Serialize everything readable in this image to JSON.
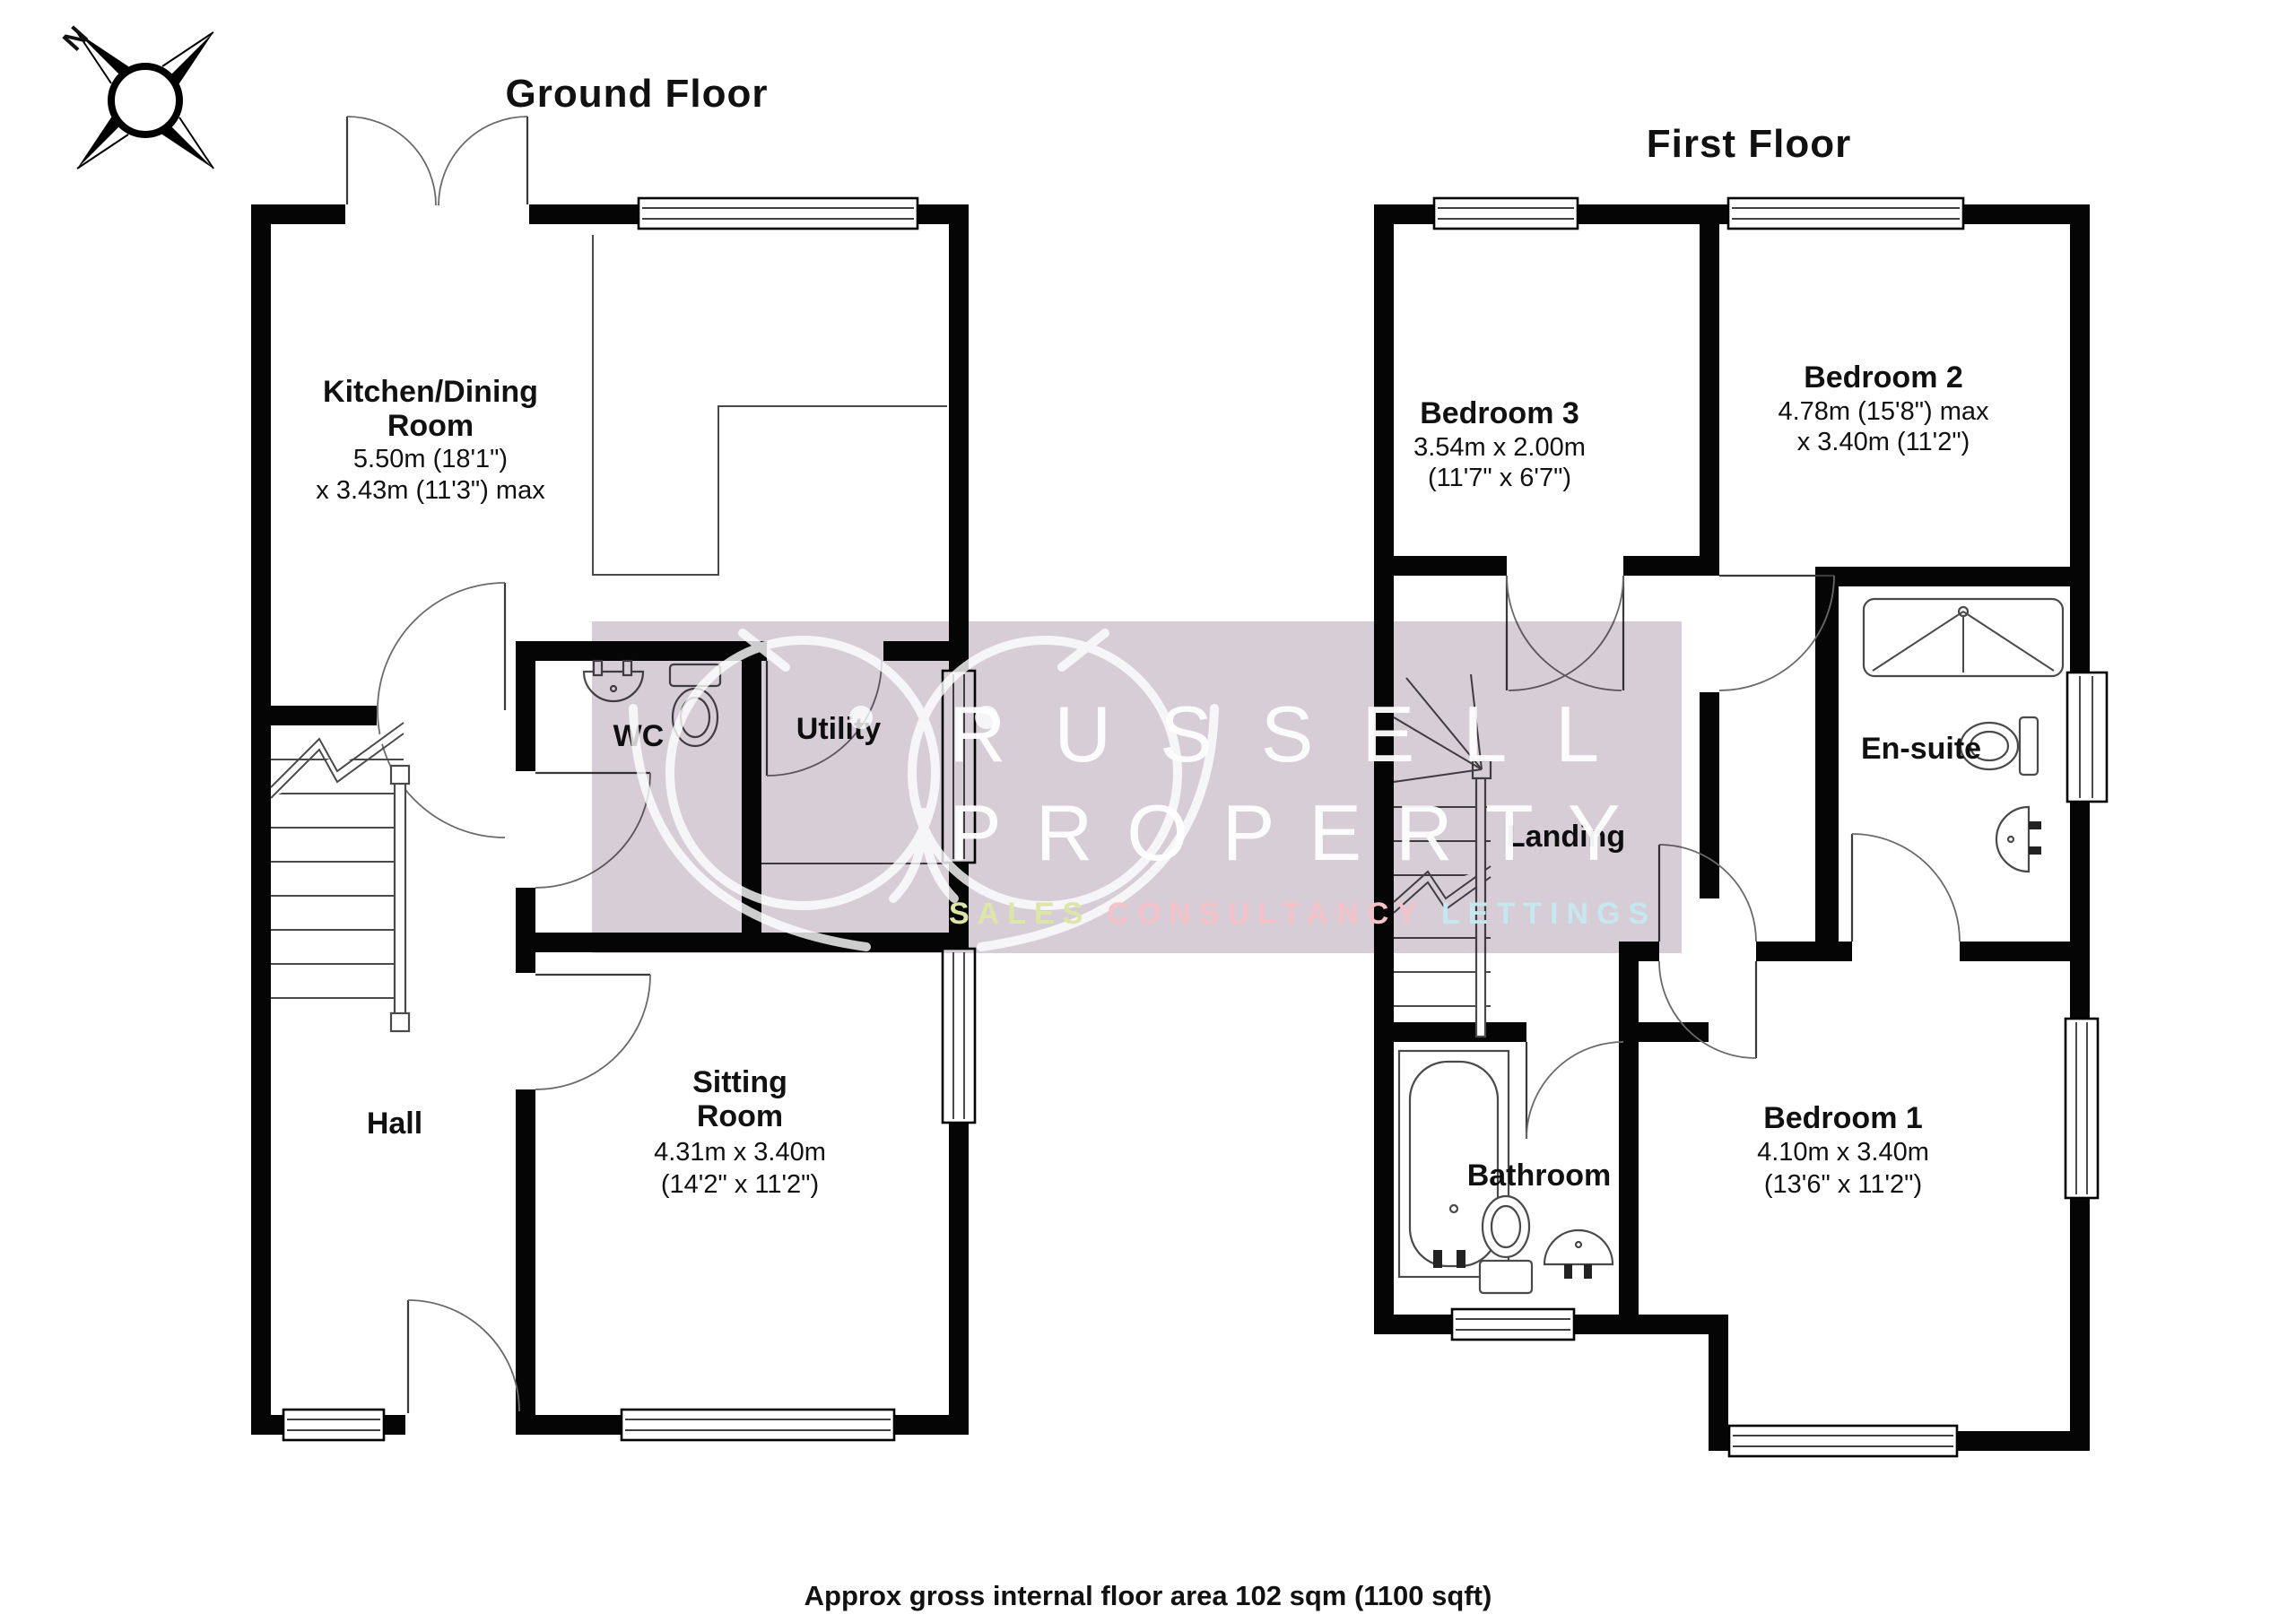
{
  "header": {
    "ground_floor_title": "Ground Floor",
    "first_floor_title": "First Floor",
    "compass_label": "N"
  },
  "footer": {
    "area_note": "Approx gross internal floor area 102 sqm (1100 sqft)"
  },
  "watermark": {
    "line1": "RUSSELL",
    "line2": "PROPERTY",
    "sales_label": "SALES",
    "consultancy_label": "CONSULTANCY",
    "lettings_label": "LETTINGS",
    "band_color": "#d6cdd7",
    "sales_color": "#dde6a6",
    "consultancy_color": "#f6c2c9",
    "lettings_color": "#c5e8ee"
  },
  "ground_floor": {
    "rooms": {
      "kitchen": {
        "name1": "Kitchen/Dining",
        "name2": "Room",
        "dim1": "5.50m (18'1\")",
        "dim2": "x 3.43m (11'3\") max"
      },
      "wc": {
        "name": "WC"
      },
      "utility": {
        "name": "Utility"
      },
      "hall": {
        "name": "Hall"
      },
      "sitting": {
        "name1": "Sitting",
        "name2": "Room",
        "dim1": "4.31m x 3.40m",
        "dim2": "(14'2\" x 11'2\")"
      }
    }
  },
  "first_floor": {
    "rooms": {
      "bedroom3": {
        "name": "Bedroom 3",
        "dim1": "3.54m x 2.00m",
        "dim2": "(11'7\" x 6'7\")"
      },
      "bedroom2": {
        "name": "Bedroom 2",
        "dim1": "4.78m (15'8\") max",
        "dim2": "x 3.40m (11'2\")"
      },
      "ensuite": {
        "name": "En-suite"
      },
      "landing": {
        "name": "Landing"
      },
      "bathroom": {
        "name": "Bathroom"
      },
      "bedroom1": {
        "name": "Bedroom 1",
        "dim1": "4.10m x 3.40m",
        "dim2": "(13'6\" x 11'2\")"
      }
    }
  }
}
